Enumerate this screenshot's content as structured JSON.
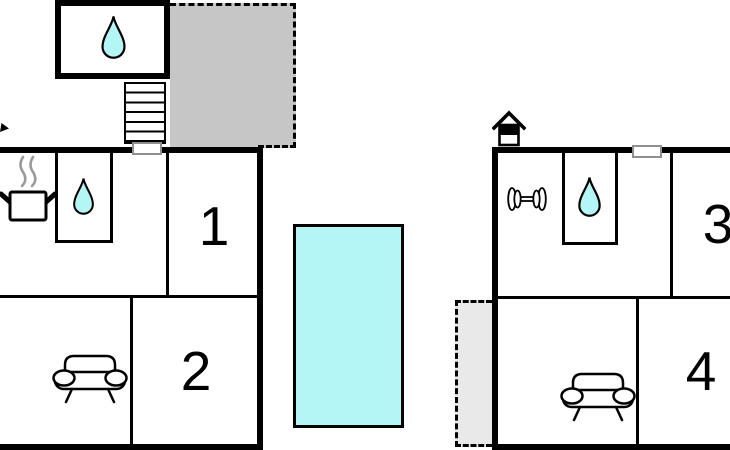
{
  "plan_title": "two-unit holiday home floor plan",
  "colors": {
    "wall": "#000000",
    "terrace_fill": "#c6c6c6",
    "patio_fill": "#e9e9e9",
    "water": "#b4f6f6",
    "window_border": "#8f8f8f",
    "steam": "#9a9a9a",
    "icon_stroke": "#000000"
  },
  "rooms": [
    {
      "label": "1"
    },
    {
      "label": "2"
    },
    {
      "label": "3"
    },
    {
      "label": "4"
    }
  ],
  "icons": {
    "upper_bathroom": "water-drop",
    "left_kitchen": "cooking-pot",
    "left_bathroom": "water-drop",
    "left_living_room": "sofa",
    "right_gym": "dumbbell",
    "right_bathroom": "water-drop",
    "right_living_room": "sofa",
    "main_entrance": "house",
    "stairway": "stairs",
    "pool": "swimming-pool",
    "terrace": "terrace",
    "patio": "patio"
  }
}
